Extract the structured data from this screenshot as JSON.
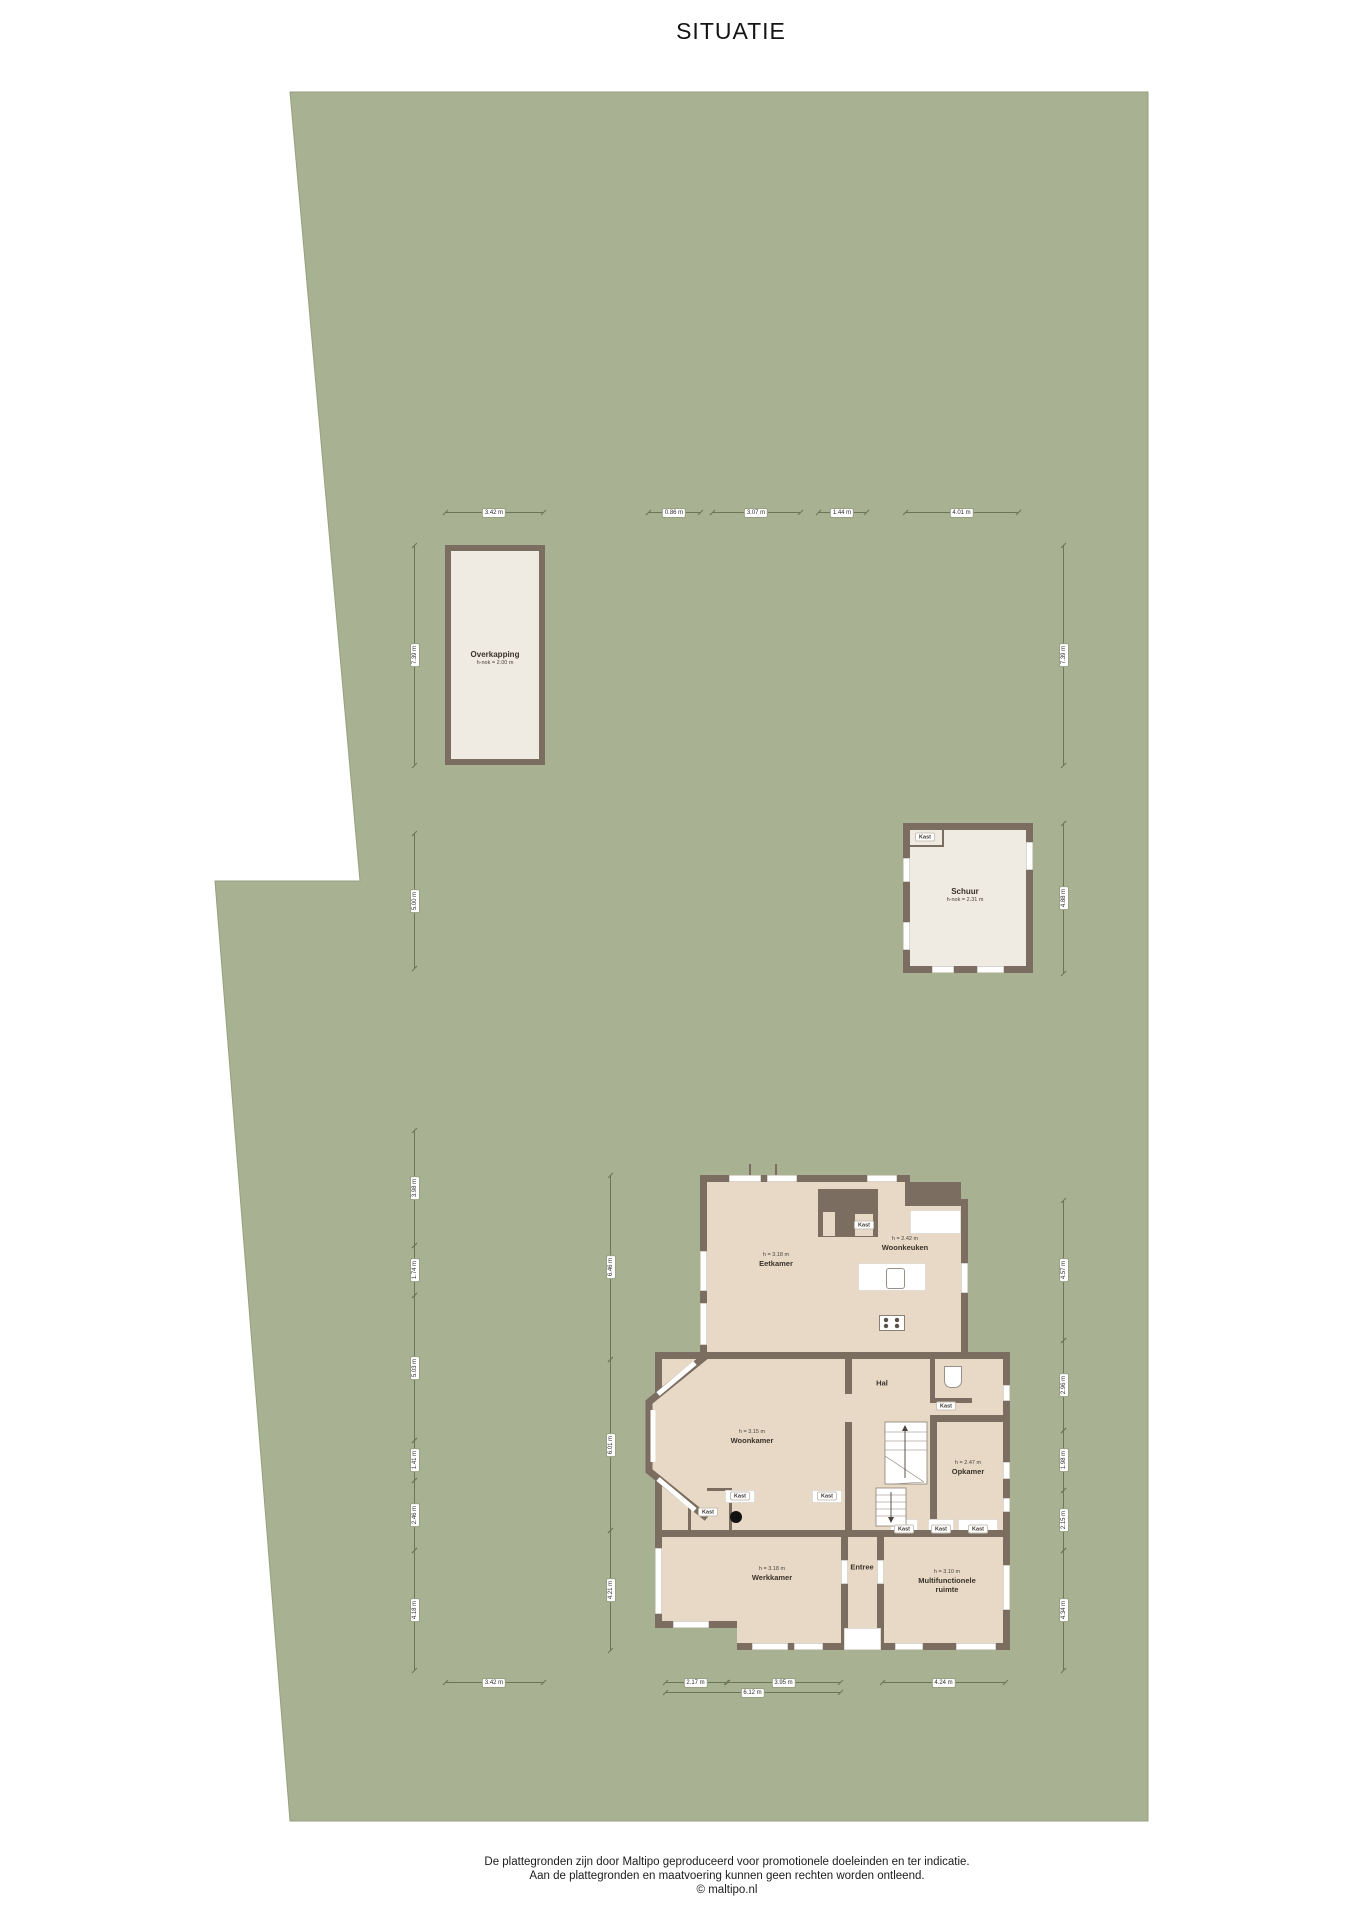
{
  "title": "SITUATIE",
  "colors": {
    "plot_green": "#a8b292",
    "wall": "#7b6e61",
    "house_room": "#e7d9c5",
    "outbuilding": "#efeae2",
    "dimension": "#6b7558"
  },
  "buildings": {
    "overkapping": {
      "name": "Overkapping",
      "note": "h-nok = 2.00 m"
    },
    "schuur": {
      "name": "Schuur",
      "note": "h-nok = 2.31 m",
      "closet": "Kast"
    }
  },
  "house": {
    "rooms": [
      {
        "note": "h = 3.18 m",
        "name": "Eetkamer",
        "x": 776,
        "y": 1260
      },
      {
        "note": "h = 2.42 m",
        "name": "Woonkeuken",
        "x": 905,
        "y": 1244
      },
      {
        "note": "h = 3.15 m",
        "name": "Woonkamer",
        "x": 752,
        "y": 1437
      },
      {
        "note": "",
        "name": "Hal",
        "x": 882,
        "y": 1383
      },
      {
        "note": "h = 2.47 m",
        "name": "Opkamer",
        "x": 968,
        "y": 1468
      },
      {
        "note": "h = 3.18 m",
        "name": "Werkkamer",
        "x": 772,
        "y": 1574
      },
      {
        "note": "",
        "name": "Entree",
        "x": 862,
        "y": 1567
      },
      {
        "note": "h = 3.10 m",
        "name": "Multifunctionele ruimte",
        "x": 947,
        "y": 1582
      }
    ],
    "closets": [
      {
        "label": "Kast",
        "x": 864,
        "y": 1225
      },
      {
        "label": "Kast",
        "x": 946,
        "y": 1406
      },
      {
        "label": "Kast",
        "x": 708,
        "y": 1512
      },
      {
        "label": "Kast",
        "x": 740,
        "y": 1496
      },
      {
        "label": "Kast",
        "x": 827,
        "y": 1496
      },
      {
        "label": "Kast",
        "x": 904,
        "y": 1529
      },
      {
        "label": "Kast",
        "x": 941,
        "y": 1529
      },
      {
        "label": "Kast",
        "x": 978,
        "y": 1529
      }
    ]
  },
  "dimensions": {
    "horizontal": [
      {
        "label": "3.42 m",
        "x1": 445,
        "x2": 543,
        "y": 512
      },
      {
        "label": "0.86 m",
        "x1": 648,
        "x2": 700,
        "y": 512
      },
      {
        "label": "3.07 m",
        "x1": 712,
        "x2": 800,
        "y": 512
      },
      {
        "label": "1.44 m",
        "x1": 818,
        "x2": 866,
        "y": 512
      },
      {
        "label": "4.01 m",
        "x1": 905,
        "x2": 1018,
        "y": 512
      },
      {
        "label": "3.42 m",
        "x1": 445,
        "x2": 543,
        "y": 1682
      },
      {
        "label": "2.17 m",
        "x1": 665,
        "x2": 726,
        "y": 1682
      },
      {
        "label": "3.95 m",
        "x1": 727,
        "x2": 840,
        "y": 1682
      },
      {
        "label": "6.12 m",
        "x1": 665,
        "x2": 840,
        "y": 1692
      },
      {
        "label": "4.24 m",
        "x1": 882,
        "x2": 1005,
        "y": 1682
      }
    ],
    "vertical": [
      {
        "label": "7.39 m",
        "y1": 545,
        "y2": 765,
        "x": 414
      },
      {
        "label": "5.00 m",
        "y1": 833,
        "y2": 968,
        "x": 414
      },
      {
        "label": "3.98 m",
        "y1": 1130,
        "y2": 1245,
        "x": 414
      },
      {
        "label": "1.74 m",
        "y1": 1245,
        "y2": 1295,
        "x": 414
      },
      {
        "label": "5.03 m",
        "y1": 1295,
        "y2": 1440,
        "x": 414
      },
      {
        "label": "1.41 m",
        "y1": 1440,
        "y2": 1480,
        "x": 414
      },
      {
        "label": "2.46 m",
        "y1": 1480,
        "y2": 1550,
        "x": 414
      },
      {
        "label": "4.18 m",
        "y1": 1550,
        "y2": 1670,
        "x": 414
      },
      {
        "label": "6.46 m",
        "y1": 1175,
        "y2": 1359,
        "x": 610
      },
      {
        "label": "6.01 m",
        "y1": 1359,
        "y2": 1530,
        "x": 610
      },
      {
        "label": "4.21 m",
        "y1": 1530,
        "y2": 1650,
        "x": 610
      },
      {
        "label": "7.39 m",
        "y1": 545,
        "y2": 765,
        "x": 1063
      },
      {
        "label": "4.88 m",
        "y1": 823,
        "y2": 973,
        "x": 1063
      },
      {
        "label": "4.57 m",
        "y1": 1200,
        "y2": 1340,
        "x": 1063
      },
      {
        "label": "2.96 m",
        "y1": 1340,
        "y2": 1430,
        "x": 1063
      },
      {
        "label": "1.98 m",
        "y1": 1430,
        "y2": 1490,
        "x": 1063
      },
      {
        "label": "2.15 m",
        "y1": 1490,
        "y2": 1550,
        "x": 1063
      },
      {
        "label": "4.34 m",
        "y1": 1550,
        "y2": 1670,
        "x": 1063
      }
    ]
  },
  "footer": {
    "line1": "De plattegronden zijn door Maltipo geproduceerd voor promotionele doeleinden en ter indicatie.",
    "line2": "Aan de plattegronden en maatvoering kunnen geen rechten worden ontleend.",
    "line3": "© maltipo.nl"
  }
}
